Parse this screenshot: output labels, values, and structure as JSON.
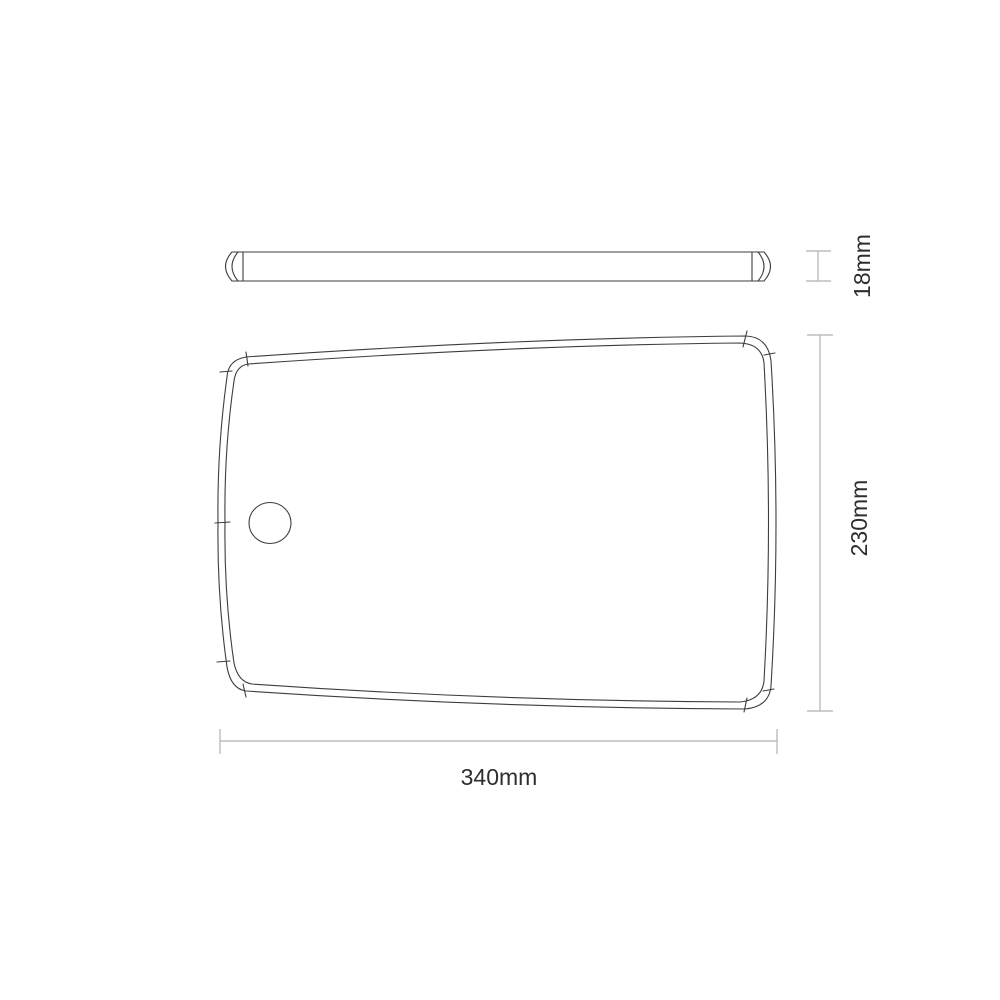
{
  "drawing": {
    "type": "technical-dimension-drawing",
    "subject": "chopping-board",
    "views": {
      "side": {
        "name": "side profile view"
      },
      "top": {
        "name": "top plan view"
      }
    },
    "dimensions": {
      "thickness": {
        "label": "18mm"
      },
      "height": {
        "label": "230mm"
      },
      "width": {
        "label": "340mm"
      }
    },
    "colors": {
      "outline": "#3d3d3d",
      "dimension_line": "#b0b0b0",
      "text": "#2e2e2e",
      "background": "#ffffff"
    }
  }
}
